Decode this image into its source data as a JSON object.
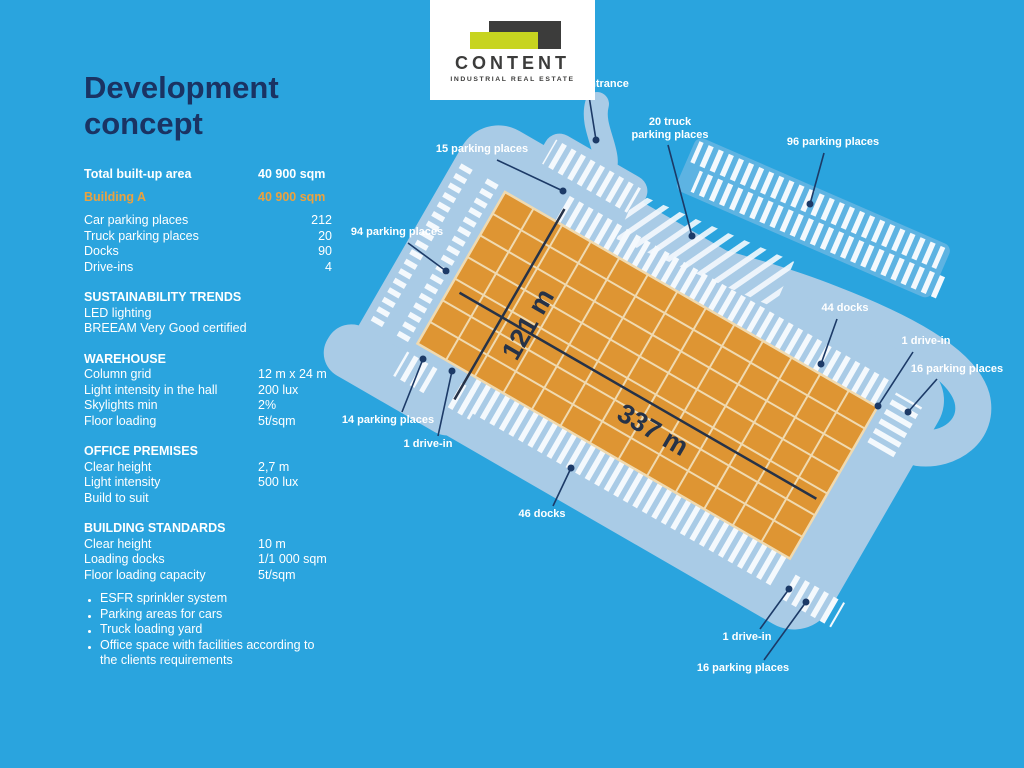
{
  "panel": {
    "title_line1": "Development",
    "title_line2": "concept",
    "summary": [
      {
        "label": "Total built-up area",
        "value": "40 900 sqm"
      },
      {
        "label": "Building A",
        "value": "40 900 sqm"
      }
    ],
    "counts": [
      {
        "label": "Car parking places",
        "value": "212"
      },
      {
        "label": "Truck parking places",
        "value": "20"
      },
      {
        "label": "Docks",
        "value": "90"
      },
      {
        "label": "Drive-ins",
        "value": "4"
      }
    ],
    "sections": [
      {
        "heading": "SUSTAINABILITY TRENDS",
        "rows": [
          {
            "label": "LED lighting",
            "value": ""
          },
          {
            "label": "BREEAM Very Good certified",
            "value": ""
          }
        ]
      },
      {
        "heading": "WAREHOUSE",
        "rows": [
          {
            "label": "Column grid",
            "value": "12 m x 24 m"
          },
          {
            "label": "Light intensity in the hall",
            "value": "200 lux"
          },
          {
            "label": "Skylights min",
            "value": "2%"
          },
          {
            "label": "Floor loading",
            "value": "5t/sqm"
          }
        ]
      },
      {
        "heading": "OFFICE PREMISES",
        "rows": [
          {
            "label": "Clear height",
            "value": "2,7 m"
          },
          {
            "label": "Light intensity",
            "value": "500 lux"
          },
          {
            "label": "Build to suit",
            "value": ""
          }
        ]
      },
      {
        "heading": "BUILDING STANDARDS",
        "rows": [
          {
            "label": "Clear height",
            "value": "10 m"
          },
          {
            "label": "Loading docks",
            "value": "1/1 000 sqm"
          },
          {
            "label": "Floor loading capacity",
            "value": "5t/sqm"
          }
        ]
      }
    ],
    "bullets": [
      "ESFR sprinkler system",
      "Parking areas for cars",
      "Truck loading yard",
      "Office space with facilities according to the clients requirements"
    ]
  },
  "logo": {
    "name": "CONTENT",
    "tagline": "INDUSTRIAL REAL ESTATE"
  },
  "diagram": {
    "dimensions": {
      "width": "121 m",
      "length": "337 m"
    },
    "callouts": [
      {
        "text": "entrance"
      },
      {
        "text": "15 parking places"
      },
      {
        "text": "20 truck",
        "text2": "parking places"
      },
      {
        "text": "96 parking places"
      },
      {
        "text": "94 parking places"
      },
      {
        "text": "44 docks"
      },
      {
        "text": "1 drive-in"
      },
      {
        "text": "16 parking places"
      },
      {
        "text": "14 parking places"
      },
      {
        "text": "1 drive-in"
      },
      {
        "text": "46 docks"
      },
      {
        "text": "1 drive-in"
      },
      {
        "text": "16 parking places"
      }
    ],
    "colors": {
      "background": "#2AA4DE",
      "road": "#A9CBE6",
      "building": "#DE9533",
      "building_grid": "#F0DAB0",
      "hatch": "#F4F9FD",
      "leader_navy": "#1C3A67",
      "dimension": "#263247",
      "title_navy": "#1A3363",
      "accent_orange": "#EBA23F",
      "logo_lime": "#C7D420",
      "logo_dark": "#3C3C3B"
    }
  }
}
